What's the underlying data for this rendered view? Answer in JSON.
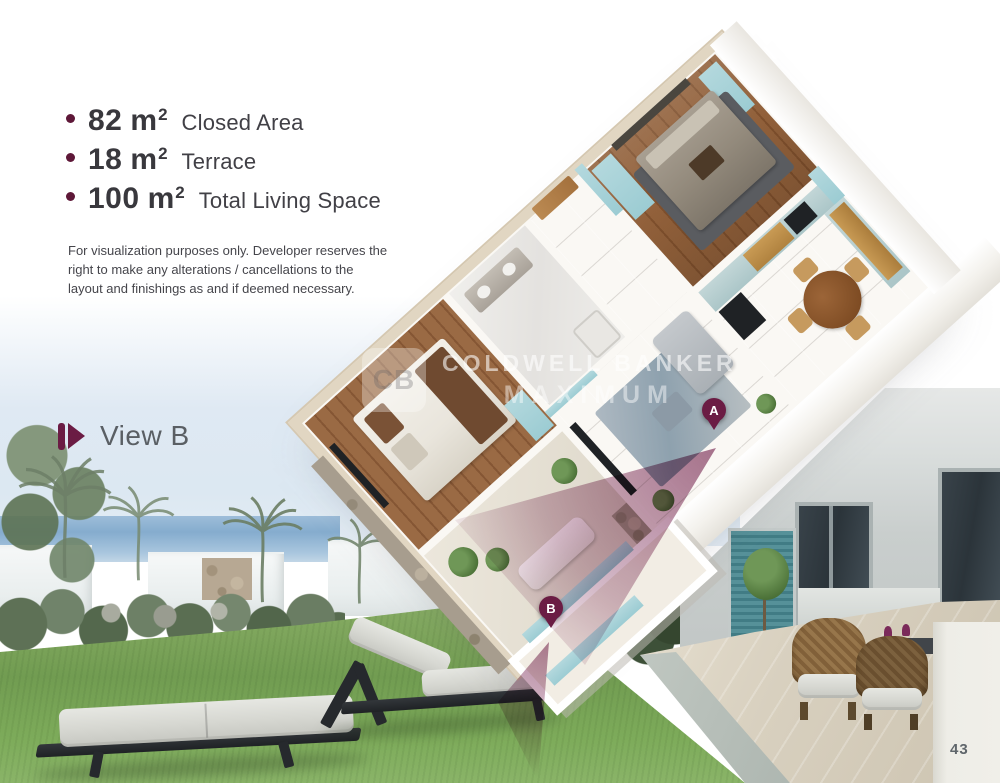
{
  "specs": {
    "items": [
      {
        "value": "82",
        "unit": "m",
        "sup": "2",
        "label": "Closed Area"
      },
      {
        "value": "18",
        "unit": "m",
        "sup": "2",
        "label": "Terrace"
      },
      {
        "value": "100",
        "unit": "m",
        "sup": "2",
        "label": "Total Living Space"
      }
    ]
  },
  "disclaimer": {
    "lines": [
      "For visualization purposes only. Developer reserves the",
      "right to make any alterations / cancellations to the",
      "layout and finishings as and if deemed necessary."
    ]
  },
  "view_label": {
    "label": "View B"
  },
  "watermark": {
    "monogram": "CB",
    "line1": "COLDWELL BANKER",
    "line2": "MAXIMUM"
  },
  "markers": {
    "a": "A",
    "b": "B"
  },
  "page": {
    "number": "43"
  },
  "colors": {
    "accent_maroon": "#6b1c44",
    "bullet": "#5e1838",
    "teal_furniture": "#a7d3d9",
    "teal_shutter": "#4f8e96",
    "wall_top_beige": "#e1d6c2",
    "wood_floor": "#8a5a36",
    "lawn_green": "#78a057",
    "sky_blue": "#dce8f2",
    "sea_blue": "#8fb3d4",
    "text_dark": "#39383d",
    "text_gray": "#5a5f64"
  }
}
